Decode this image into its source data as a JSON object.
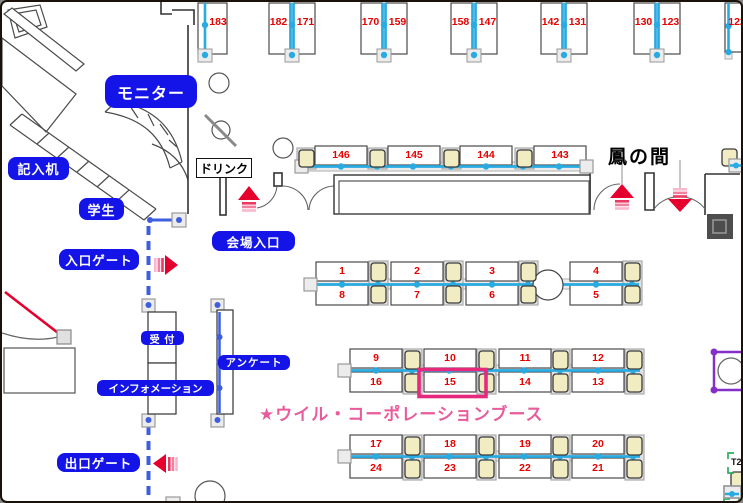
{
  "plan": {
    "room_label": "鳳の間",
    "labels": {
      "monitor": "モニター",
      "writing_desk": "記入机",
      "student": "学生",
      "entrance_gate": "入口ゲート",
      "venue_entrance": "会場入口",
      "drink": "ドリンク",
      "reception": "受 付",
      "information": "インフォメーション",
      "survey": "アンケート",
      "exit_gate": "出口ゲート",
      "t2_marker": "T2"
    },
    "highlight": {
      "booth": "15",
      "caption": "★ウイル・コーポレーションブース",
      "border_color": "#e7297e",
      "text_color": "#e85c9b"
    },
    "top_booths": [
      {
        "left": "",
        "right": "183"
      },
      {
        "left": "182",
        "right": "171"
      },
      {
        "left": "170",
        "right": "159"
      },
      {
        "left": "158",
        "right": "147"
      },
      {
        "left": "142",
        "right": "131"
      },
      {
        "left": "130",
        "right": "123"
      },
      {
        "left": "122",
        "right": ""
      }
    ],
    "wall_booths": [
      "146",
      "145",
      "144",
      "143"
    ],
    "island_rows": [
      {
        "top": [
          "1",
          "2",
          "3",
          "4"
        ],
        "bottom": [
          "8",
          "7",
          "6",
          "5"
        ]
      },
      {
        "top": [
          "9",
          "10",
          "11",
          "12"
        ],
        "bottom": [
          "16",
          "15",
          "14",
          "13"
        ]
      },
      {
        "top": [
          "17",
          "18",
          "19",
          "20"
        ],
        "bottom": [
          "24",
          "23",
          "22",
          "21"
        ]
      }
    ],
    "colors": {
      "label_blue": "#1414e8",
      "booth_number_red": "#e60000",
      "partition_cyan": "#29abe2",
      "path_royal_blue": "#3f5ede",
      "arrow_red": "#e6002d",
      "chair_fill": "#f2ecc3",
      "column_purple": "#8430c8",
      "marker_green": "#2fae5f"
    }
  }
}
